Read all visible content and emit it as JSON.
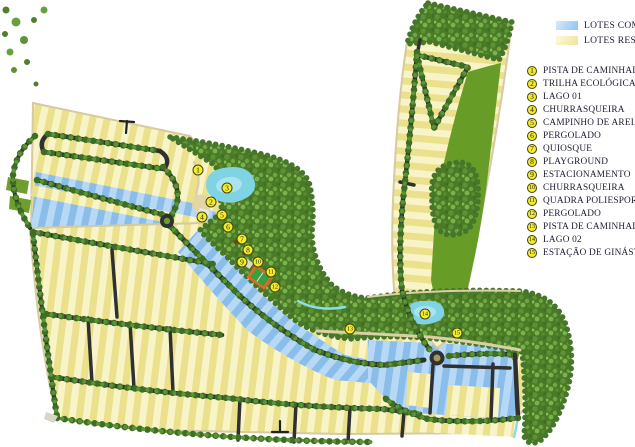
{
  "legend": {
    "swatches": [
      {
        "label": "LOTES COME",
        "type": "commercial",
        "color": "#a9cdf0"
      },
      {
        "label": "LOTES RESID",
        "type": "residential",
        "color": "#f5efb9"
      }
    ],
    "items": [
      {
        "num": "1",
        "label": "PISTA DE CAMINHADA"
      },
      {
        "num": "2",
        "label": "TRILHA ECOLÓGICA"
      },
      {
        "num": "3",
        "label": "LAGO 01"
      },
      {
        "num": "4",
        "label": "CHURRASQUEIRA"
      },
      {
        "num": "5",
        "label": "CAMPINHO DE AREIA"
      },
      {
        "num": "6",
        "label": "PERGOLADO"
      },
      {
        "num": "7",
        "label": "QUIOSQUE"
      },
      {
        "num": "8",
        "label": "PLAYGROUND"
      },
      {
        "num": "9",
        "label": "ESTACIONAMENTO"
      },
      {
        "num": "10",
        "label": "CHURRASQUEIRA"
      },
      {
        "num": "11",
        "label": "QUADRA POLIESPORT"
      },
      {
        "num": "12",
        "label": "PERGOLADO"
      },
      {
        "num": "13",
        "label": "PISTA DE CAMINHADA"
      },
      {
        "num": "14",
        "label": "LAGO 02"
      },
      {
        "num": "15",
        "label": "ESTAÇÃO DE GINÁSTIC"
      }
    ]
  },
  "map": {
    "markers": [
      {
        "num": "1",
        "x": 198,
        "y": 170
      },
      {
        "num": "2",
        "x": 211,
        "y": 202
      },
      {
        "num": "3",
        "x": 227,
        "y": 188
      },
      {
        "num": "4",
        "x": 202,
        "y": 217
      },
      {
        "num": "5",
        "x": 222,
        "y": 215
      },
      {
        "num": "6",
        "x": 228,
        "y": 227
      },
      {
        "num": "7",
        "x": 242,
        "y": 239
      },
      {
        "num": "8",
        "x": 248,
        "y": 250
      },
      {
        "num": "9",
        "x": 242,
        "y": 262
      },
      {
        "num": "10",
        "x": 258,
        "y": 262
      },
      {
        "num": "11",
        "x": 271,
        "y": 272
      },
      {
        "num": "12",
        "x": 275,
        "y": 287
      },
      {
        "num": "13",
        "x": 350,
        "y": 329
      },
      {
        "num": "14",
        "x": 425,
        "y": 314
      },
      {
        "num": "15",
        "x": 457,
        "y": 333
      }
    ],
    "colors": {
      "residential_lot": "#f5efb9",
      "commercial_lot": "#a9cdf0",
      "road": "#303030",
      "forest": "#4a7a28",
      "open_green": "#679d26",
      "water": "#7fd3e2",
      "marker": "#f2ec2b"
    }
  }
}
